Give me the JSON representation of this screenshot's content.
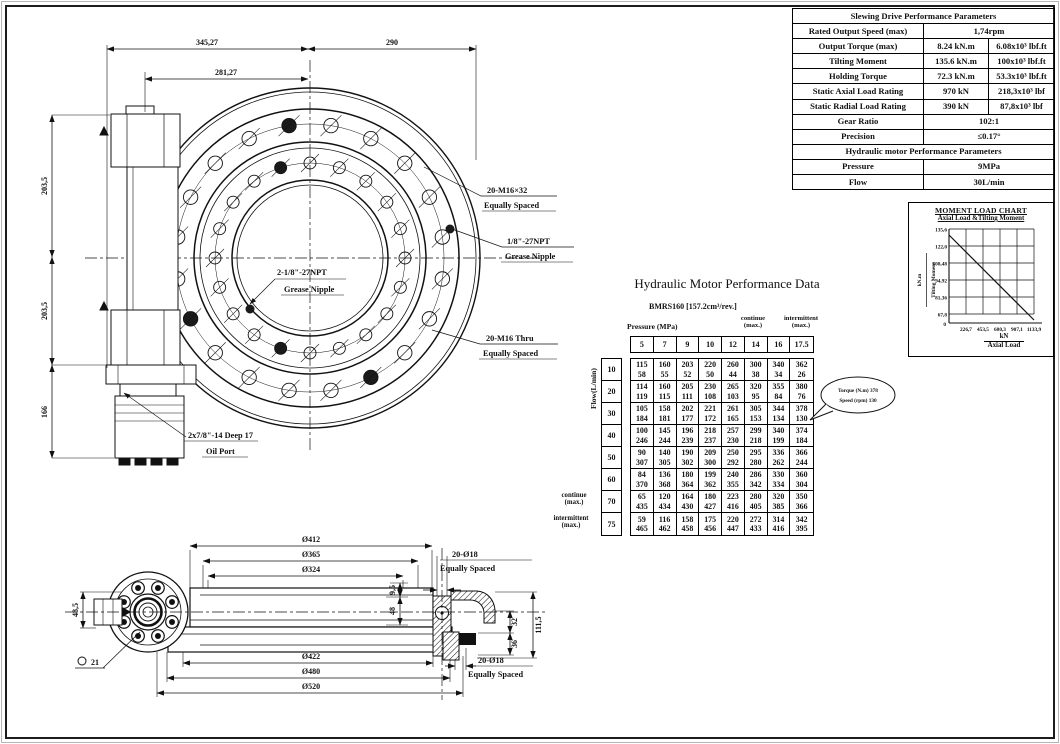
{
  "perf": {
    "title": "Slewing Drive Performance Parameters",
    "speed": {
      "label": "Rated Output Speed (max)",
      "v": "1,74rpm"
    },
    "torque": {
      "label": "Output Torque (max)",
      "v1": "8.24 kN.m",
      "v2": "6.08x10³ lbf.ft"
    },
    "tilting": {
      "label": "Tilting Moment",
      "v1": "135.6 kN.m",
      "v2": "100x10³ lbf.ft"
    },
    "holding": {
      "label": "Holding Torque",
      "v1": "72.3 kN.m",
      "v2": "53.3x10³ lbf.ft"
    },
    "axial": {
      "label": "Static Axial Load Rating",
      "v1": "970 kN",
      "v2": "218,3x10³ lbf"
    },
    "radial": {
      "label": "Static Radial Load Rating",
      "v1": "390 kN",
      "v2": "87,8x10³ lbf"
    },
    "gear": {
      "label": "Gear Ratio",
      "v": "102:1"
    },
    "precision": {
      "label": "Precision",
      "v": "≤0.17°"
    },
    "subheader": "Hydraulic motor Performance Parameters",
    "pressure": {
      "label": "Pressure",
      "v": "9MPa"
    },
    "flow": {
      "label": "Flow",
      "v": "30L/min"
    }
  },
  "chart_data": {
    "type": "line",
    "title": "MOMENT LOAD CHART",
    "subtitle": "Axial Load &Tilting Moment",
    "ylabel_unit": "kN.m",
    "ylabel": "Tilting Moment",
    "xlabel_unit": "kN",
    "xlabel": "Axial Load",
    "origin_label": "0",
    "y_tick_labels": [
      "135,6",
      "122,0",
      "108,48",
      "94,92",
      "81,36",
      "67,8"
    ],
    "x_tick_labels": [
      "226,7",
      "453,5",
      "680,3",
      "907,1",
      "1133,9"
    ],
    "y_ticks": [
      135.6,
      122.0,
      108.48,
      94.92,
      81.36,
      67.8
    ],
    "x_ticks": [
      0,
      226.7,
      453.5,
      680.3,
      907.1,
      1133.9
    ],
    "x_range": [
      0,
      1133.9
    ],
    "y_grid_range": [
      67.8,
      135.6
    ],
    "grid": true,
    "legend": "none",
    "series": [
      {
        "name": "Axial Load vs Tilting Moment limit",
        "points": [
          [
            0,
            133.0
          ],
          [
            1133.9,
            64.0
          ]
        ]
      }
    ]
  },
  "motor": {
    "title": "Hydraulic Motor Performance Data",
    "model": "BMRS160 [157.2cm³/rev.]",
    "pressure_label": "Pressure (MPa)",
    "flow_label": "Flow(L/min)",
    "continue_l1": "continue",
    "continue_l2": "(max.)",
    "intermit_l1": "intermittent",
    "intermit_l2": "(max.)",
    "pressures": [
      "5",
      "7",
      "9",
      "10",
      "12",
      "14",
      "16",
      "17.5"
    ],
    "flows": [
      "10",
      "20",
      "30",
      "40",
      "50",
      "60",
      "70",
      "75"
    ],
    "rows": [
      {
        "torque": [
          115,
          160,
          203,
          220,
          260,
          300,
          340,
          362
        ],
        "speed": [
          58,
          55,
          52,
          50,
          44,
          38,
          34,
          26
        ]
      },
      {
        "torque": [
          114,
          160,
          205,
          230,
          265,
          320,
          355,
          380
        ],
        "speed": [
          119,
          115,
          111,
          108,
          103,
          95,
          84,
          76
        ]
      },
      {
        "torque": [
          105,
          158,
          202,
          221,
          261,
          305,
          344,
          378
        ],
        "speed": [
          184,
          181,
          177,
          172,
          165,
          153,
          134,
          130
        ]
      },
      {
        "torque": [
          100,
          145,
          196,
          218,
          257,
          299,
          340,
          374
        ],
        "speed": [
          246,
          244,
          239,
          237,
          230,
          218,
          199,
          184
        ]
      },
      {
        "torque": [
          90,
          140,
          190,
          209,
          250,
          295,
          336,
          366
        ],
        "speed": [
          307,
          305,
          302,
          300,
          292,
          280,
          262,
          244
        ]
      },
      {
        "torque": [
          84,
          136,
          180,
          199,
          240,
          286,
          330,
          360
        ],
        "speed": [
          370,
          368,
          364,
          362,
          355,
          342,
          334,
          304
        ]
      },
      {
        "torque": [
          65,
          120,
          164,
          180,
          223,
          280,
          320,
          350
        ],
        "speed": [
          435,
          434,
          430,
          427,
          416,
          405,
          385,
          366
        ]
      },
      {
        "torque": [
          59,
          116,
          158,
          175,
          220,
          272,
          314,
          342
        ],
        "speed": [
          465,
          462,
          458,
          456,
          447,
          433,
          416,
          395
        ]
      }
    ],
    "callout_line1": "Torque (N.m) 378",
    "callout_line2": "Speed (rpm) 130"
  },
  "top_view": {
    "dim_345": "345,27",
    "dim_281": "281,27",
    "dim_290": "290",
    "dim_203a": "203,5",
    "dim_203b": "203,5",
    "dim_166": "166",
    "label_m16x32_1": "20-M16×32",
    "label_m16x32_2": "Equally Spaced",
    "label_npt1_1": "1/8\"-27NPT",
    "label_npt1_2": "Grease Nipple",
    "label_npt2_1": "2-1/8\"-27NPT",
    "label_npt2_2": "Grease Nipple",
    "label_m16thru_1": "20-M16 Thru",
    "label_m16thru_2": "Equally Spaced",
    "label_oil_1": "2x7/8\"-14 Deep 17",
    "label_oil_2": "Oil Port"
  },
  "section_view": {
    "dim_412": "Ø412",
    "dim_365": "Ø365",
    "dim_324": "Ø324",
    "dim_422": "Ø422",
    "dim_480": "Ø480",
    "dim_520": "Ø520",
    "label_2018_top_1": "20-Ø18",
    "label_2018_top_2": "Equally Spaced",
    "label_2018_bot_1": "20-Ø18",
    "label_2018_bot_2": "Equally Spaced",
    "dim_485": "48,5",
    "dim_1115": "111,5",
    "dim_95": "9,5",
    "dim_48": "48",
    "dim_32": "32",
    "dim_36": "36",
    "dim_21": "21"
  }
}
